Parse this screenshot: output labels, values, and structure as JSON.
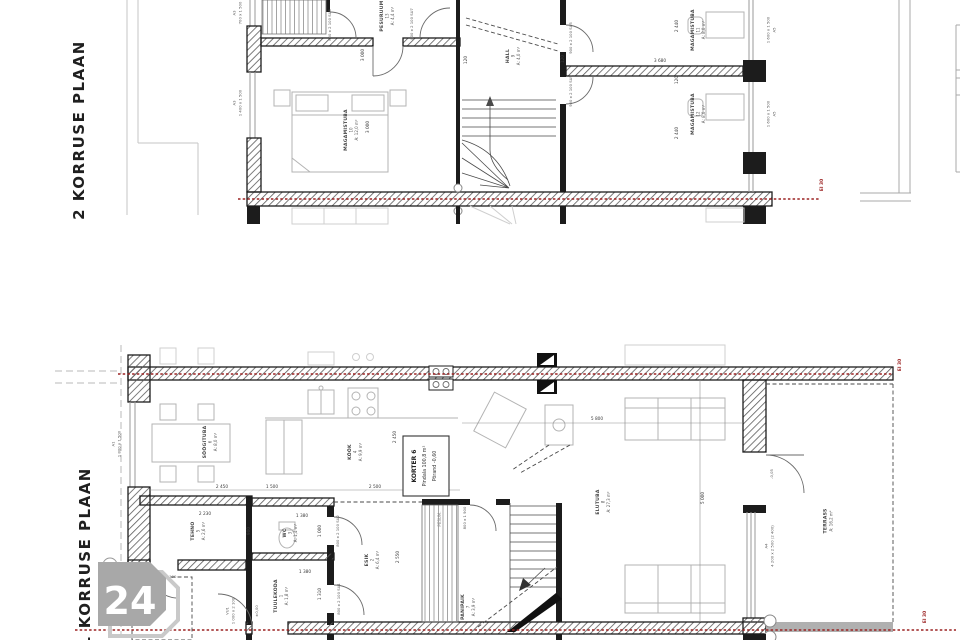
{
  "app": {
    "floor2_label": "2 KORRUSE PLAAN",
    "floor1_label": "1 KORRUSE PLAAN",
    "logo": "24",
    "fire_rating": "EI 30"
  },
  "apartment": {
    "title": "KORTER 6",
    "area_line": "Pindala 100,8 m²",
    "floor_line": "Põrand -0,60"
  },
  "plan2": {
    "rooms": {
      "magamistuba10": {
        "name": "MAGAMISTUBA",
        "num": "10",
        "area": "A: 12,0 m²"
      },
      "hall": {
        "name": "HALL",
        "num": "9",
        "area": "A: 4,0 m²"
      },
      "pesuruum": {
        "name": "PESURUUM",
        "num": "13",
        "area": "A: 4,4 m²"
      },
      "magamistuba11": {
        "name": "MAGAMISTUBA",
        "num": "11",
        "area": "A: 8,0 m²"
      },
      "magamistuba12": {
        "name": "MAGAMISTUBA",
        "num": "12",
        "area": "A: 8,0 m²"
      }
    },
    "dims": {
      "d3000": "3 000",
      "d2440": "2 440",
      "d3680": "3 680",
      "d120": "120"
    },
    "openings": {
      "a3_code": "A3",
      "a3_top": "700 x 1 500",
      "a3_win": "1 400 x 1 500",
      "a5_code": "A5",
      "a5_win": "1 600 x 1 500",
      "su5": "900 x 2 100 SU5",
      "su6": "800 x 2 100 SU6",
      "su7": "800 x 2 100 SU7"
    }
  },
  "plan1": {
    "rooms": {
      "soogituba": {
        "name": "SÖÖGITUBA",
        "num": "6",
        "area": "A: 8,0 m²"
      },
      "kook": {
        "name": "KÖÖK",
        "num": "4",
        "area": "A: 9,9 m²"
      },
      "tehno": {
        "name": "TEHNO",
        "num": "5",
        "area": "A: 2,6 m²"
      },
      "wc": {
        "name": "WC",
        "num": "3",
        "area": "A: 1,4 m²"
      },
      "tuulekoda": {
        "name": "TUULEKODA",
        "num": "1",
        "area": "A: 1,8 m²"
      },
      "esik": {
        "name": "ESIK",
        "num": "2",
        "area": "A: 6,4 m²"
      },
      "panipaik": {
        "name": "PANIPAIK",
        "num": "7",
        "area": "A: 3,9 m²"
      },
      "elutuba": {
        "name": "ELUTUBA",
        "num": "8",
        "area": "A: 27,3 m²"
      },
      "terrass": {
        "name": "TERRASS",
        "area": "A: 16,2 m²"
      },
      "pesum": {
        "name": "PESUM."
      }
    },
    "dims": {
      "d2450": "2 450",
      "d1500": "1 500",
      "d2500": "2 500",
      "d2230": "2 230",
      "d900": "900",
      "d1380": "1 380",
      "d1000": "1 000",
      "d1310": "1 310",
      "d2550": "2 550",
      "d5800": "5 800",
      "d5000": "5 000"
    },
    "openings": {
      "a1_code": "A1",
      "a1_win": "1 800 x 1 500",
      "a4_code": "A4",
      "a4_win": "4 200 x 2 500 (2 400)",
      "vu1_code": "VU1",
      "vu1_size": "1 000 x 2 100",
      "su1": "800 x 2 100 SU1",
      "su2": "800 x 2 100 SU2",
      "tehno_door": "800 x 2 100",
      "panipaik_door": "800 x 1 900"
    },
    "levels": {
      "zero": "±0,00",
      "terrace": "-0,05"
    }
  }
}
